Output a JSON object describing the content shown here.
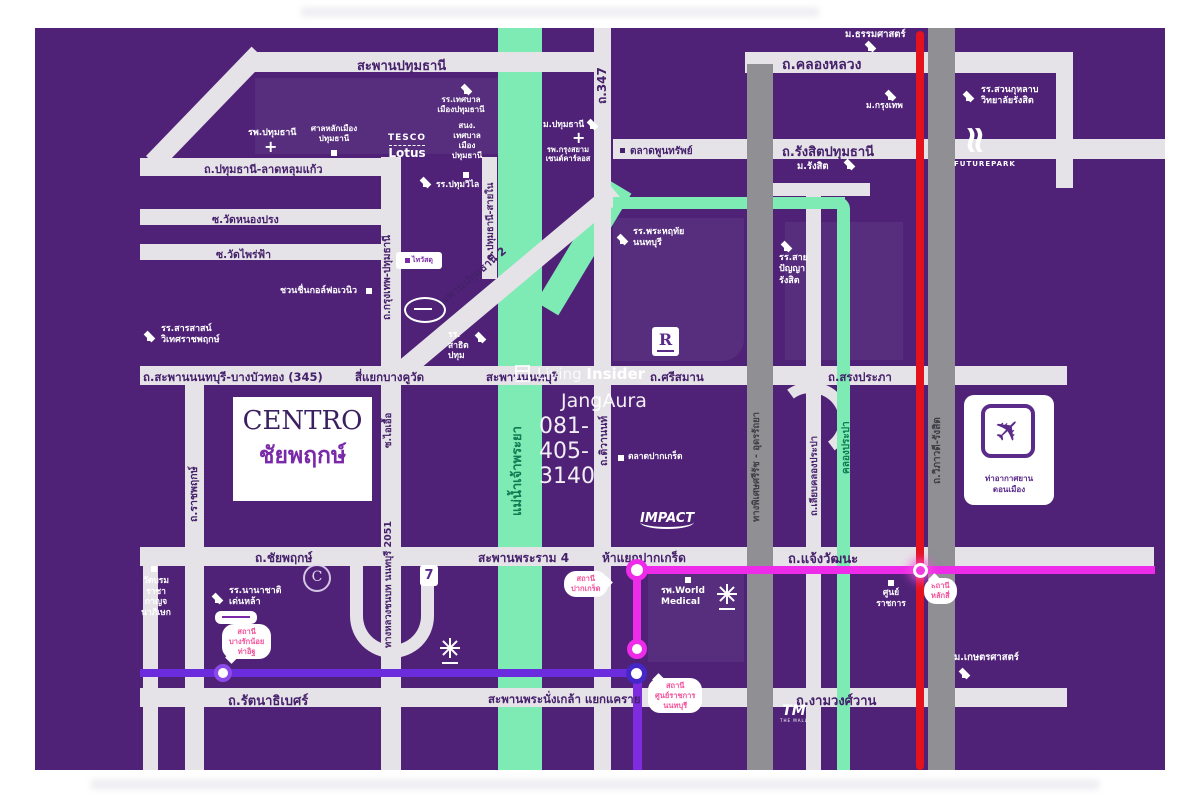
{
  "colors": {
    "map_bg": "#4F2277",
    "road": "#E6E3E8",
    "river": "#7EEBB4",
    "expressway_gray": "#8F8F94",
    "tollway_red": "#E4121C",
    "mrt_pink": "#EE2BE8",
    "mrt_purple": "#6A2CDC",
    "bubble_text": "#F2549C",
    "road_label": "#45216B",
    "water_label": "#0E7B52"
  },
  "project": {
    "name_en": "CENTRO",
    "name_th": "ชัยพฤกษ์"
  },
  "watermark": {
    "brand_light": "Living",
    "brand_bold": "Insider",
    "name": "JangAura",
    "phone": "081-405-3140"
  },
  "roads": {
    "saphan_pathumthani": "สะพานปทุมธานี",
    "khlong_luang": "ถ.คลองหลวง",
    "rt347": "ถ.347",
    "rangsit_pathumthani": "ถ.รังสิตปทุมธานี",
    "pathumthani_latlumkaeo": "ถ.ปทุมธานี-ลาดหลุมแก้ว",
    "soi_wat_nong_prong": "ซ.วัดหนองปรง",
    "soi_wat_phrai_fa": "ซ.วัดไพร่ฟ้า",
    "krungthep_pathumthani": "ถ.กรุงเทพ-ปทุมธานี",
    "pathumthani_sai_nai": "ถ.ปทุมธานี-สายใน",
    "saphan_pathumthani2": "สะพานปทุมธานี 2",
    "saphan_nonthaburi_345": "ถ.สะพานนนทบุรี-บางบัวทอง (345)",
    "si_yaek_bang_khu_wat": "สี่แยกบางคูวัด",
    "saphan_nonthaburi": "สะพานนนทบุรี",
    "srisaman": "ถ.ศรีสมาน",
    "song_prapha": "ถ.สรงประภา",
    "ratchapruek": "ถ.ราชพฤกษ์",
    "soi_ai_uea": "ซ.ไอเอื้อ",
    "rural_nonthaburi_2051": "ทางหลวงชนบท นนทบุรี 2051",
    "chaiyapruek": "ถ.ชัยพฤกษ์",
    "saphan_rama4": "สะพานพระราม 4",
    "ha_yaek_pak_kret": "ห้าแยกปากเกร็ด",
    "chaengwattana": "ถ.แจ้งวัฒนะ",
    "tiwanon": "ถ.ติวานนท์",
    "srirat_expressway": "ทางพิเศษศรีรัช - อุดรรัถยา",
    "liap_khlong_prapa": "ถ.เลียบคลองประปา",
    "viphavadi_rangsit": "ถ.วิภาวดี-รังสิต",
    "rattanathibet": "ถ.รัตนาธิเบศร์",
    "saphan_phra_nangklao": "สะพานพระนั่งเกล้า แยกแคราย",
    "ngamwongwan": "ถ.งามวงศ์วาน"
  },
  "waterways": {
    "chao_phraya": "แม่น้ำเจ้าพระยา",
    "khlong_prapa": "คลองประปา"
  },
  "places": {
    "thammasat": "ม.ธรรมศาสตร์",
    "bangkok_u": "ม.กรุงเทพ",
    "suan_kularb": "รร.สวนกุหลาบ\nวิทยาลัยรังสิต",
    "rangsit_u": "ม.รังสิต",
    "talat_phunsap": "ตลาดพูนทรัพย์",
    "school_thetsaban": "รร.เทศบาล\nเมืองปทุมธานี",
    "office_thetsaban": "สนง.\nเทศบาล\nเมือง\nปทุมธานี",
    "pathumthani_u": "ม.ปทุมธานี",
    "krungsiam_hospital": "รพ.กรุงสยาม\nเซนต์คาร์ลอส",
    "pathumthani_hospital": "รพ.ปทุมธานี",
    "city_pillar": "ศาลหลักเมือง\nปทุมธานี",
    "pathum_wilai": "รร.ปทุมวิไล",
    "chuan_chuen_golf": "ชวนชื่นกอล์ฟอเวนิว",
    "sarasas": "รร.สารสาสน์\nวิเทศราชพฤกษ์",
    "satit_pathum": "รร.\nสาธิต\nปทุม",
    "phra_haruethai": "รร.พระหฤทัย\nนนทบุรี",
    "sai_panya": "รร.สาย\nปัญญา\nรังสิต",
    "talat_pak_kret": "ตลาดปากเกร็ด",
    "world_medical": "รพ.World\nMedical",
    "denla": "รร.นานาชาติ\nเด่นหล้า",
    "wat_borom": "วัดบรม\nราชา\nกาญจ\nนาภิเษก",
    "gov_complex": "ศูนย์\nราชการ",
    "kasetsart": "ม.เกษตรศาสตร์",
    "don_mueang": "ท่าอากาศยาน\nดอนเมือง"
  },
  "transit": {
    "stations": {
      "pak_kret": "สถานี\nปากเกร็ด",
      "gov_center_nonthaburi": "สถานี\nศูนย์ราชการ\nนนทบุรี",
      "lak_si": "สถานี\nหลักสี่",
      "bang_rak_noi": "สถานี\nบางรักน้อย\nท่าอิฐ"
    }
  },
  "logos": {
    "tesco": "TESCO",
    "lotus": "Lotus",
    "impact": "IMPACT",
    "futurepark": "FUTUREPARK",
    "thaiwatsadu": "ไทวัสดุ",
    "robinson_r": "R",
    "seven": "7",
    "c_mark": "C",
    "the_mall": "TM",
    "the_mall_sub": "THE MALL"
  },
  "icons": {
    "plane": "✈",
    "cross": "+",
    "wave": "≈"
  }
}
